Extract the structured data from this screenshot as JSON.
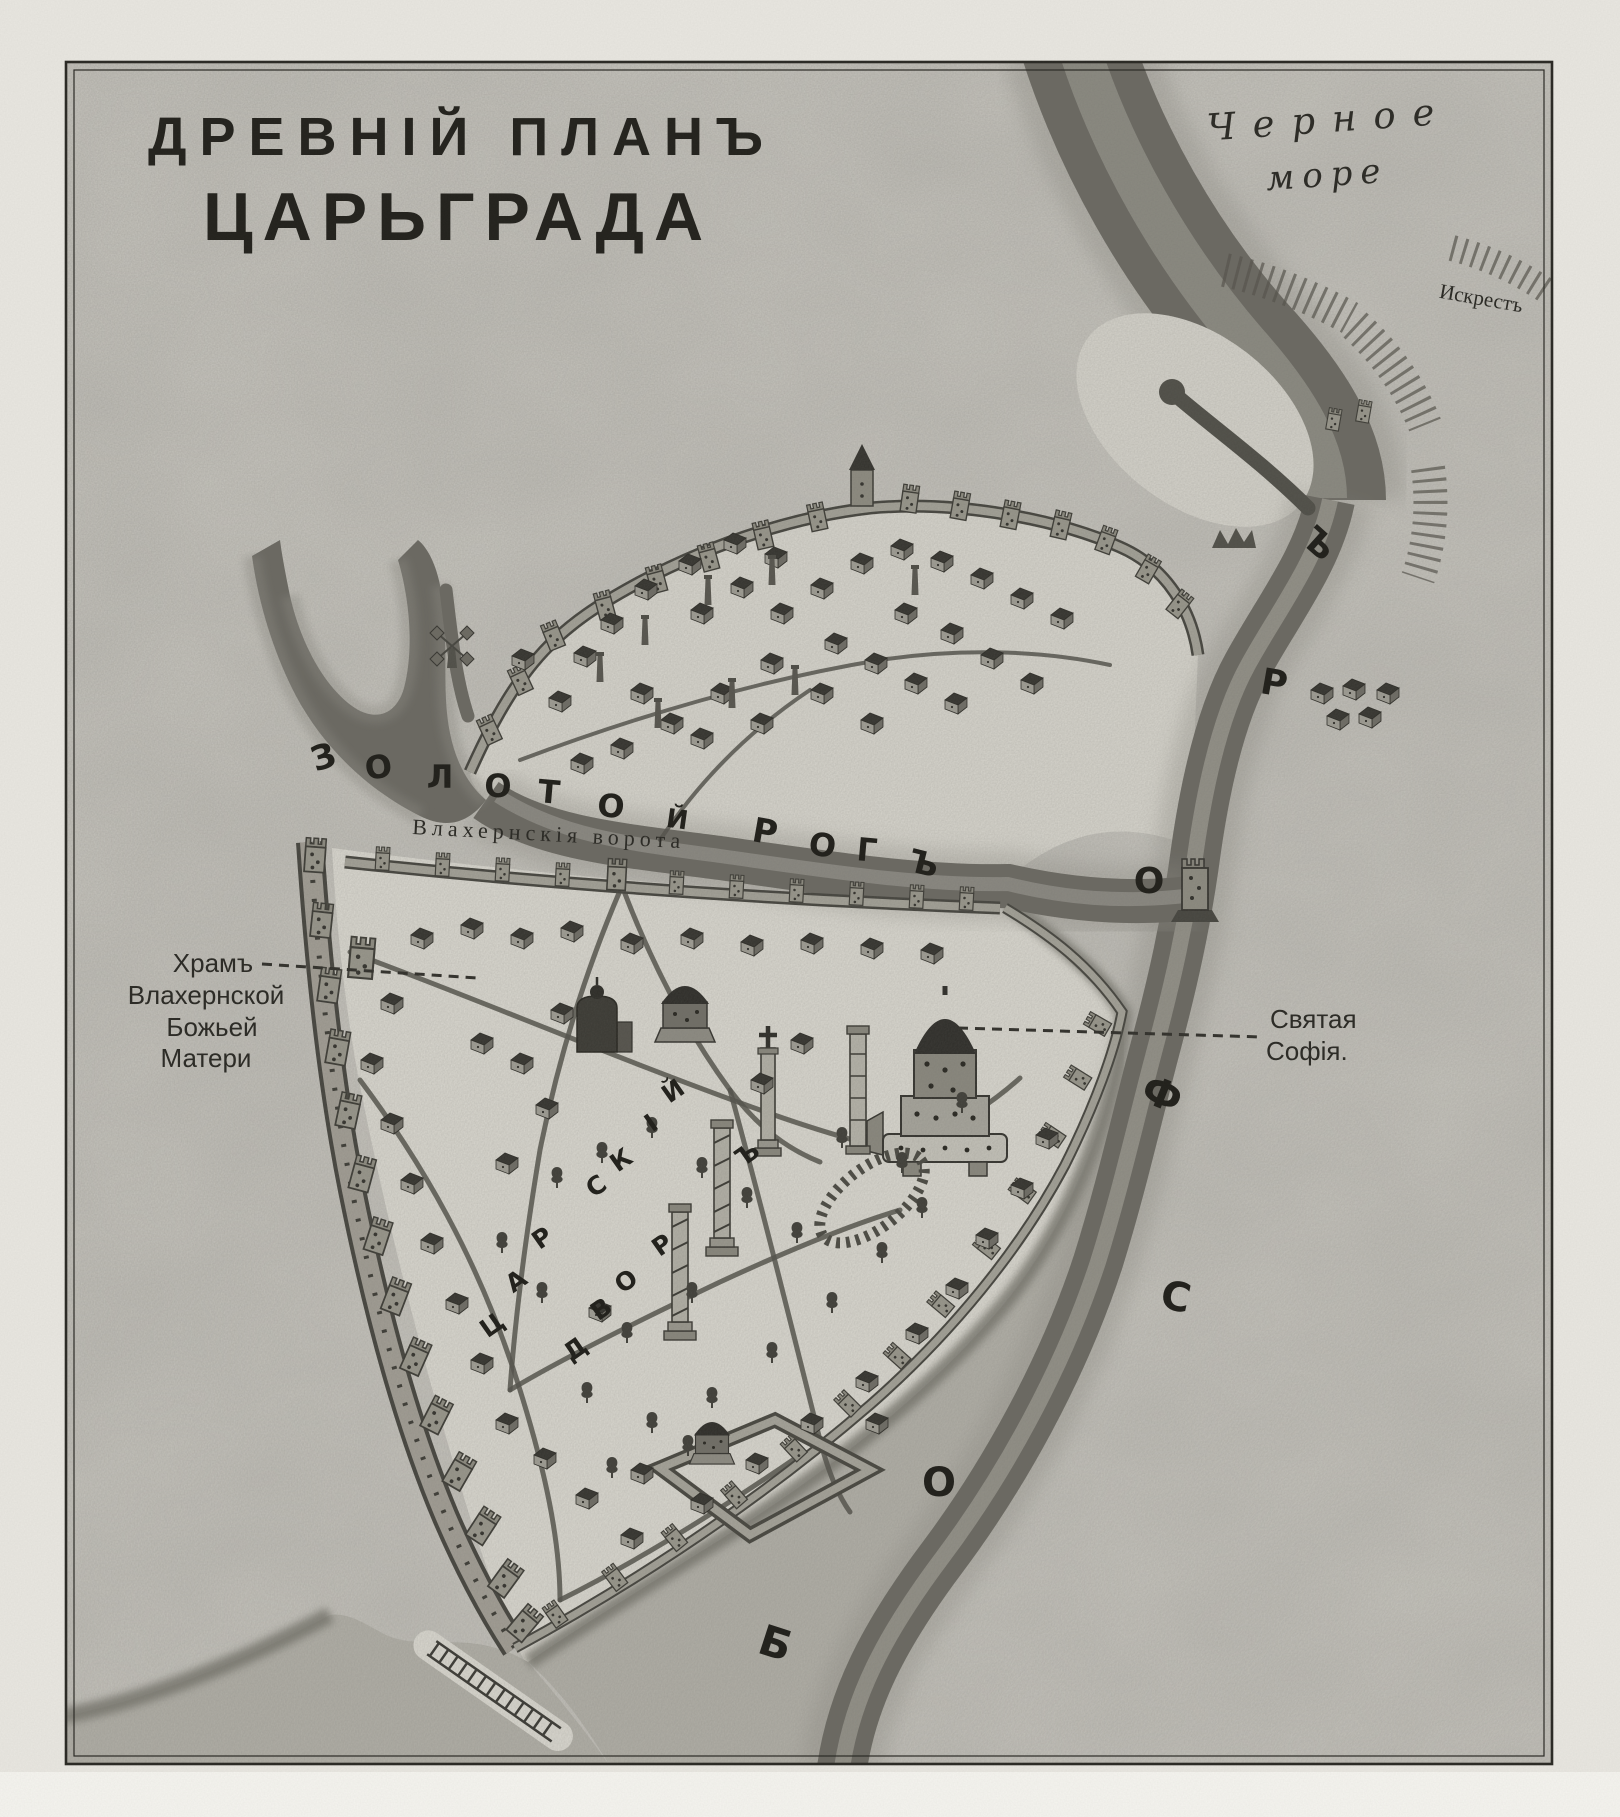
{
  "title": {
    "line1": "ДРЕВНІЙ ПЛАНЪ",
    "line2": "ЦАРЬГРАДА"
  },
  "sea_labels": {
    "black_sea_1": "Черное",
    "black_sea_2": "море",
    "cape": "Искрестъ"
  },
  "map_labels": {
    "gate": "Влахернскія ворота",
    "church_1": "Храмъ",
    "church_2": "Влахернской",
    "church_3": "Божьей",
    "church_4": "Матери",
    "sophia_1": "Святая",
    "sophia_2": "Софія."
  },
  "water_letters": {
    "golden_horn": [
      {
        "ch": "З",
        "x": 327,
        "y": 768,
        "r": -18,
        "s": 34
      },
      {
        "ch": "О",
        "x": 380,
        "y": 778,
        "r": -8,
        "s": 32
      },
      {
        "ch": "Л",
        "x": 440,
        "y": 788,
        "r": 0,
        "s": 32
      },
      {
        "ch": "О",
        "x": 498,
        "y": 797,
        "r": 0,
        "s": 32
      },
      {
        "ch": "Т",
        "x": 548,
        "y": 803,
        "r": 5,
        "s": 32
      },
      {
        "ch": "О",
        "x": 610,
        "y": 817,
        "r": 5,
        "s": 32
      },
      {
        "ch": "Й",
        "x": 676,
        "y": 828,
        "r": 8,
        "s": 26
      },
      {
        "ch": "Р",
        "x": 763,
        "y": 843,
        "r": 10,
        "s": 34
      },
      {
        "ch": "О",
        "x": 821,
        "y": 856,
        "r": 8,
        "s": 32
      },
      {
        "ch": "Г",
        "x": 866,
        "y": 861,
        "r": 5,
        "s": 32
      },
      {
        "ch": "Ъ",
        "x": 921,
        "y": 874,
        "r": 14,
        "s": 32
      }
    ],
    "bosphorus": [
      {
        "ch": "Б",
        "x": 771,
        "y": 1657,
        "r": 18,
        "s": 42
      },
      {
        "ch": "О",
        "x": 939,
        "y": 1496,
        "r": 0,
        "s": 40
      },
      {
        "ch": "С",
        "x": 1173,
        "y": 1310,
        "r": 12,
        "s": 40
      },
      {
        "ch": "Ф",
        "x": 1157,
        "y": 1107,
        "r": 22,
        "s": 40
      },
      {
        "ch": "О",
        "x": 1149,
        "y": 893,
        "r": 0,
        "s": 36
      },
      {
        "ch": "Р",
        "x": 1272,
        "y": 695,
        "r": 10,
        "s": 36
      },
      {
        "ch": "Ъ",
        "x": 1311,
        "y": 552,
        "r": 42,
        "s": 34
      }
    ],
    "palace_court": [
      {
        "ch": "Ц",
        "x": 497,
        "y": 1332,
        "r": -35,
        "s": 25
      },
      {
        "ch": "А",
        "x": 521,
        "y": 1288,
        "r": -35,
        "s": 25
      },
      {
        "ch": "Р",
        "x": 547,
        "y": 1245,
        "r": -35,
        "s": 25
      },
      {
        "ch": "С",
        "x": 601,
        "y": 1193,
        "r": -35,
        "s": 25
      },
      {
        "ch": "К",
        "x": 626,
        "y": 1167,
        "r": -35,
        "s": 25
      },
      {
        "ch": "І",
        "x": 656,
        "y": 1130,
        "r": -35,
        "s": 25
      },
      {
        "ch": "Й",
        "x": 678,
        "y": 1098,
        "r": -35,
        "s": 25
      },
      {
        "ch": "Д",
        "x": 580,
        "y": 1356,
        "r": -35,
        "s": 25
      },
      {
        "ch": "В",
        "x": 606,
        "y": 1316,
        "r": -35,
        "s": 25
      },
      {
        "ch": "О",
        "x": 631,
        "y": 1288,
        "r": -35,
        "s": 25
      },
      {
        "ch": "Р",
        "x": 667,
        "y": 1252,
        "r": -35,
        "s": 25
      },
      {
        "ch": "Ъ",
        "x": 752,
        "y": 1161,
        "r": -35,
        "s": 25
      }
    ]
  },
  "colors": {
    "paper": "#c8c6bf",
    "water_dark": "#6b6962",
    "water_mid": "#a9a79f",
    "ink": "#23221d"
  }
}
